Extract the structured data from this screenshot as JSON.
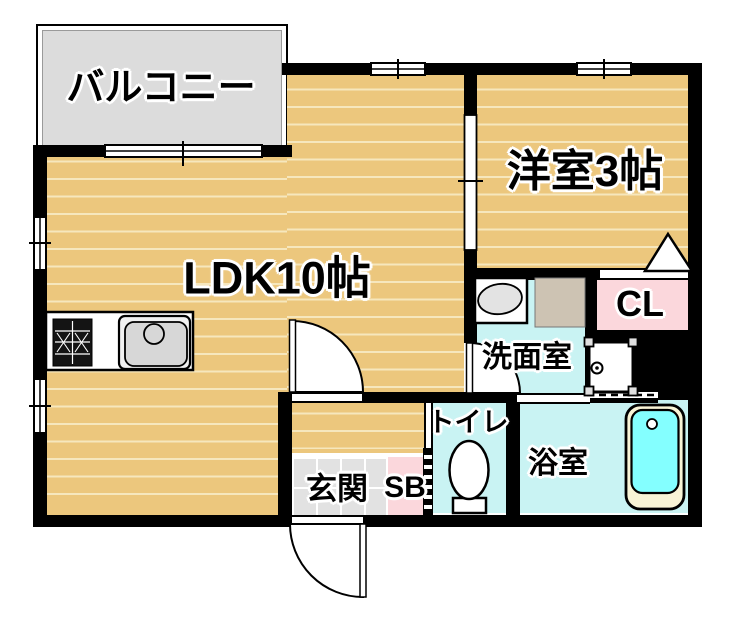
{
  "plan_type": "apartment-floor-plan",
  "rooms": {
    "balcony": {
      "label": "バルコニー"
    },
    "ldk": {
      "label": "LDK10帖"
    },
    "western_room": {
      "label": "洋室3帖"
    },
    "washroom": {
      "label": "洗面室"
    },
    "closet": {
      "label": "CL"
    },
    "toilet": {
      "label": "トイレ"
    },
    "bathroom": {
      "label": "浴室"
    },
    "entrance": {
      "label": "玄関"
    },
    "shoe_box": {
      "label": "SB"
    }
  },
  "icons": {
    "kitchen_stove": "stove-icon",
    "kitchen_sink": "sink-icon",
    "washbasin": "washbasin-icon",
    "washing_machine_pan": "washing-machine-pan-icon",
    "bathtub": "bathtub-icon",
    "toilet_bowl": "toilet-icon",
    "closet_door_swing": "triangle-door-swing-icon",
    "door_swing": "door-swing-icon",
    "window": "window-icon",
    "sliding_door": "sliding-door-icon",
    "folding_door": "folding-door-icon"
  },
  "colors": {
    "wall": "#000000",
    "wood_floor": "#ecc77d",
    "plank_line": "#f6e7bd",
    "wet_room": "#c9f3f3",
    "pink_storage": "#fbd7dc",
    "balcony_gray": "#dcdcdc",
    "tile_gray": "#e2e2e2",
    "tub_water": "#84ffff",
    "tub_rim": "#f8f4d6",
    "counter_gray": "#cdc3b3"
  }
}
